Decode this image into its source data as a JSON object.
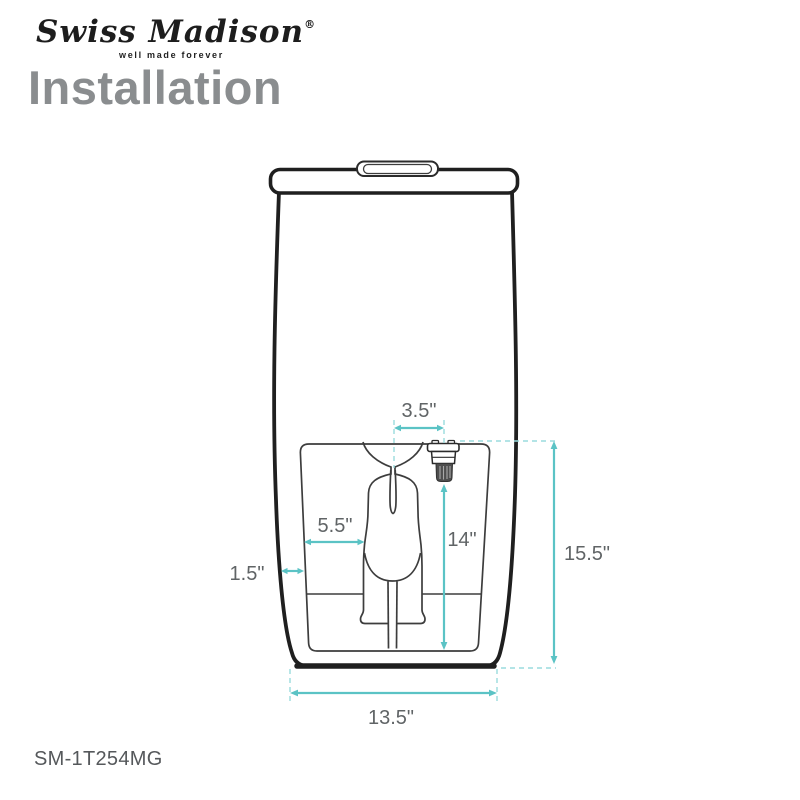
{
  "brand": {
    "logo_text": "Swiss Madison",
    "registered_mark": "®",
    "tagline": "well made forever"
  },
  "page": {
    "title": "Installation",
    "model_number": "SM-1T254MG"
  },
  "diagram": {
    "type": "toilet-front-view-installation-dimensions",
    "dimensions": [
      {
        "name": "supply-valve-offset-from-center",
        "label": "3.5\""
      },
      {
        "name": "trapway-offset",
        "label": "5.5\""
      },
      {
        "name": "shell-wall-thickness",
        "label": "1.5\""
      },
      {
        "name": "valve-height-from-base",
        "label": "14\""
      },
      {
        "name": "supply-line-height",
        "label": "15.5\""
      },
      {
        "name": "base-width",
        "label": "13.5\""
      }
    ],
    "colors": {
      "dimension_line": "#5bc3c5",
      "dashed_guide": "#9adcdd",
      "outline": "#1f1f1f",
      "label_text": "#606466"
    }
  }
}
